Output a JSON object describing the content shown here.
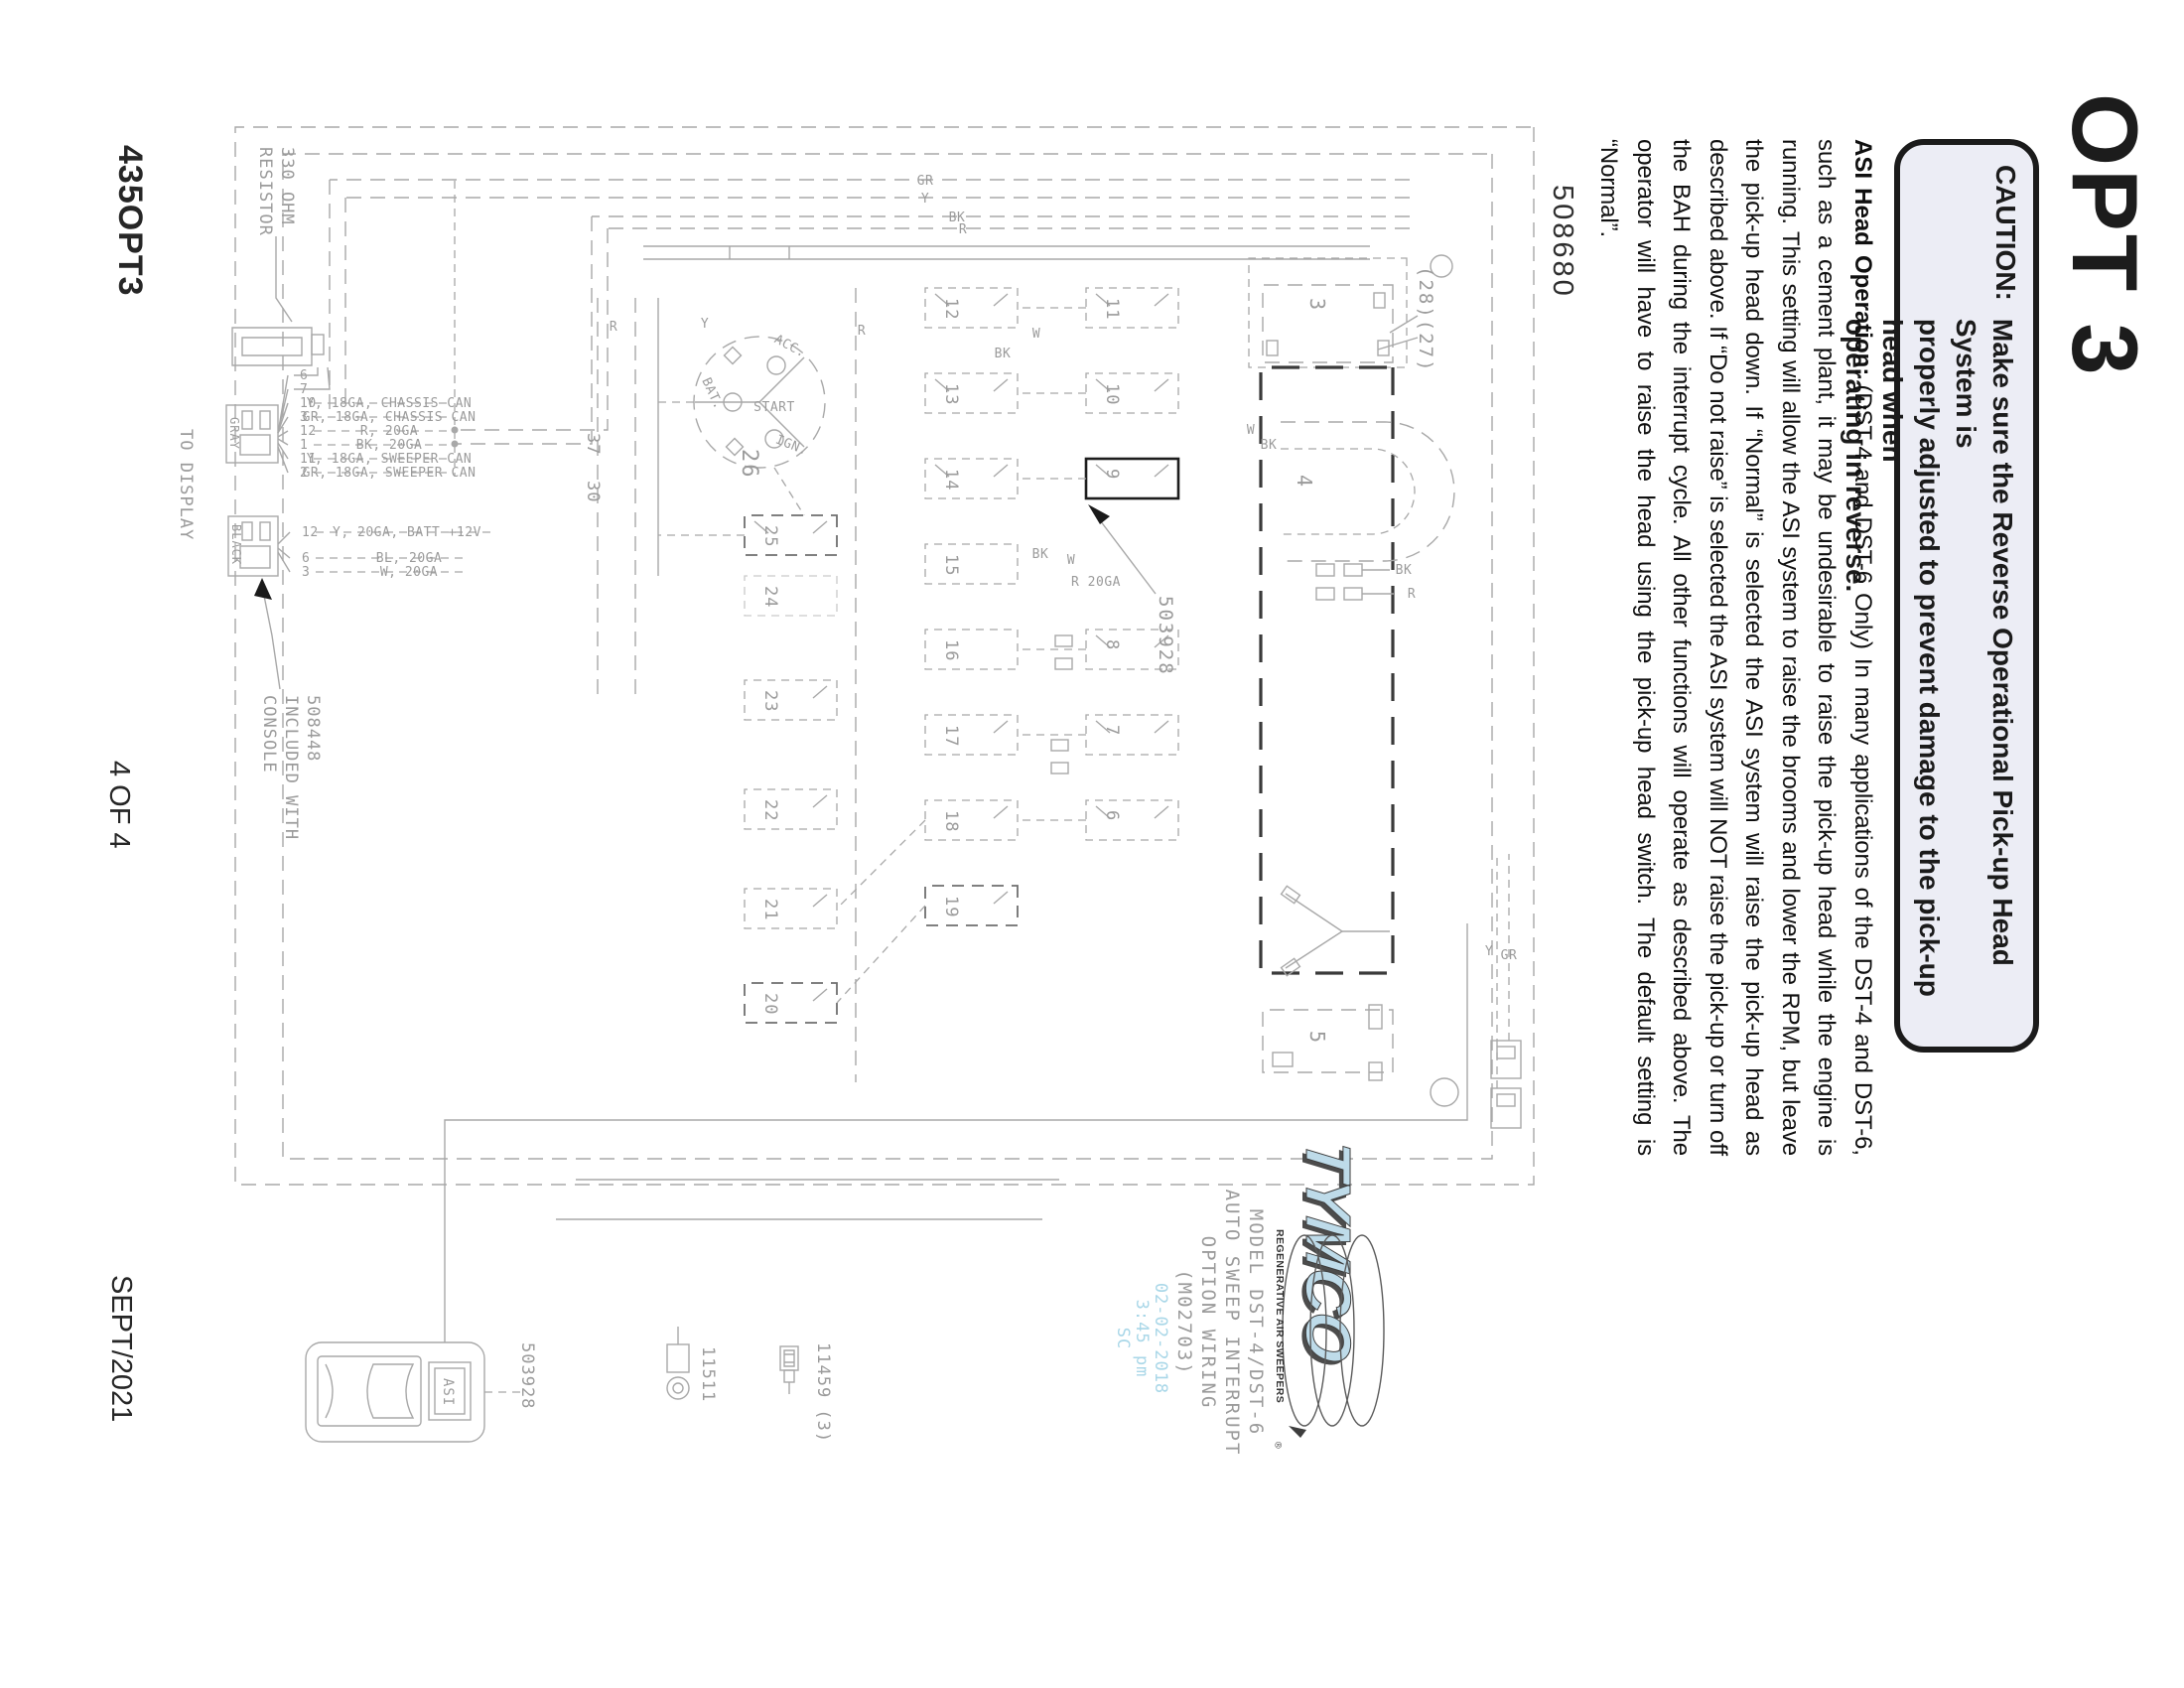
{
  "page": {
    "opt_title": "OPT 3",
    "drawing_number": "508680"
  },
  "caution": {
    "label": "CAUTION:",
    "lines": [
      "Make sure the Reverse Operational Pick-up Head System is",
      "properly adjusted to prevent damage to the pick-up head when",
      "operating in reverse."
    ]
  },
  "asi": {
    "heading": "ASI Head Operation:",
    "body": " (DST-4 and DST-6 Only) In many applications of the DST-4 and DST-6, such as a cement plant, it may be undesirable to raise the pick-up head while the engine is running. This setting will allow the ASI system to raise the brooms and lower the RPM, but leave the pick-up head down. If “Normal” is selected the ASI system will raise the pick-up head as described above. If “Do not raise” is selected the ASI system will NOT raise the pick-up or turn off the BAH during the interrupt cycle. All other functions will operate as described above. The operator will have to raise the head using the pick-up head switch. The default setting is “Normal”."
  },
  "footer": {
    "left": "435OPT3",
    "center": "4 OF 4",
    "right": "SEPT/2021"
  },
  "logo": {
    "word": "TYMCO",
    "tagline": "REGENERATIVE AIR SWEEPERS",
    "registered": "®"
  },
  "model_block": {
    "l1": "MODEL DST-4/DST-6",
    "l2": "AUTO SWEEP INTERRUPT",
    "l3": "OPTION WIRING",
    "l4": "(M02703)"
  },
  "stamp": {
    "l1": "02-02-2018",
    "l2": "3:45 pm",
    "l3": "SC"
  },
  "schematic": {
    "relay_labels": [
      "11",
      "10",
      "9",
      "8",
      "7",
      "6",
      "12",
      "13",
      "14",
      "15",
      "16",
      "17",
      "18",
      "19",
      "25",
      "24",
      "23",
      "22",
      "21",
      "20"
    ],
    "gray_pins": [
      "6",
      "7",
      "10",
      "3",
      "12",
      "1",
      "11",
      "2"
    ],
    "gray_wires": [
      "Y, 18GA, CHASSIS CAN",
      "GR, 18GA, CHASSIS CAN",
      "R, 20GA",
      "BK, 20GA",
      "Y, 18GA, SWEEPER CAN",
      "GR, 18GA, SWEEPER CAN"
    ],
    "black_pins": [
      "12",
      "6",
      "3"
    ],
    "black_wires": [
      "Y, 20GA, BATT +12V",
      "BL, 20GA",
      "W, 20GA"
    ],
    "can_labels": [
      "GR",
      "Y",
      "BK",
      "R"
    ],
    "connector_gray": "GRAY",
    "connector_black": "BLACK",
    "to_display": "TO DISPLAY",
    "resistor_l1": "330 OHM",
    "resistor_l2": "RESISTOR",
    "console_l1": "508448",
    "console_l2": "INCLUDED WITH",
    "console_l3": "CONSOLE",
    "part_relay_module": "503928",
    "part_switch": "503928",
    "part_ring_terminal": "11511",
    "part_spade_terminal": "11459 (3)",
    "key_acc": "ACC.",
    "key_bat": "BAT.",
    "key_start": "START",
    "key_ign": "IGN.",
    "key_num": "26",
    "n37": "37",
    "n30": "30",
    "n2827": "(28)(27)",
    "comp3": "3",
    "comp4": "4",
    "comp5": "5",
    "asi_switch": "ASI",
    "w_w": "W",
    "w_bk": "BK",
    "w_r": "R",
    "w_y": "Y",
    "w_gr": "GR",
    "w_r20ga": "R 20GA"
  }
}
